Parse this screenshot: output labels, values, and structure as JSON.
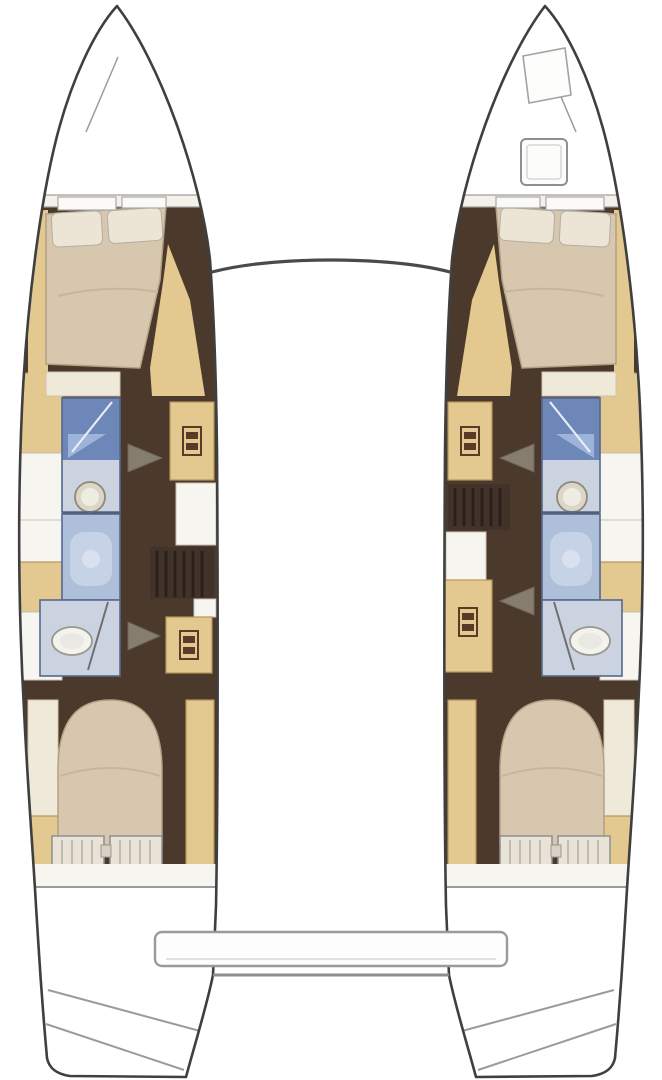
{
  "meta": {
    "description": "Top-down interior layout plan of a sailing catamaran with two hulls, four double berths, two shower and toilet compartments per hull area, companionway steps, bow trampoline beam and aft cockpit bench",
    "view": "floorplan"
  },
  "colors": {
    "outline": "#3f3f3f",
    "deckline": "#9b9b9b",
    "beam": "#4a4a4a",
    "hullfill": "#ffffff",
    "floor_dark": "#4b392c",
    "wood": "#e3c88f",
    "wood_dark": "#b3955c",
    "locker_cream": "#efe9da",
    "mattress": "#d7c7af",
    "mattress_edge": "#b2a184",
    "pillow": "#ece5d6",
    "counter_white": "#f7f5f0",
    "slat_fill": "#e9e3d7",
    "shower_dark": "#6d87b8",
    "shower_soft": "#aebfd9",
    "shower_mid": "#c6d2e6",
    "tray": "#9db3d8",
    "bath_floor": "#ccd3e0",
    "bath_border": "#55688f",
    "steps_dark": "#42332a",
    "tread": "#2a2019",
    "arrow_gray": "#867d6f",
    "hatch_icon": "#5a3b28",
    "porcelain": "#f3f2ed"
  },
  "legend": {
    "berth": "tan double mattress with two pillows",
    "shower": "blue compartment with glass-door line and tray",
    "sink": "round basin on vanity",
    "toilet": "white oval bowl",
    "companionway_steps": "dark striped stair treads",
    "deck_locker": "tan square with vent icon",
    "entry_arrow": "gray triangle pointing to companionway",
    "cockpit_bench": "rounded bar between sterns",
    "trampoline_beam": "curved beam line between bows",
    "bow_hatch": "rounded square deck hatch",
    "transom_steps": "diagonal swim-step lines at each stern"
  },
  "vessel": {
    "port_hull": {
      "forward_cabin": "double-berth",
      "head_forward": [
        "shower",
        "sink"
      ],
      "head_aft": [
        "shower",
        "toilet"
      ],
      "deck_lockers": 2,
      "aft_cabin": "double-berth"
    },
    "starboard_hull": {
      "forward_cabin": "double-berth",
      "head_forward": [
        "shower",
        "sink"
      ],
      "head_aft": [
        "shower",
        "toilet"
      ],
      "deck_lockers": 2,
      "aft_cabin": "double-berth"
    },
    "center": [
      "trampoline-beam",
      "aft-crossbeam",
      "cockpit-bench"
    ],
    "starboard_bow_deck": [
      "anchor-locker",
      "deck-hatch"
    ]
  }
}
